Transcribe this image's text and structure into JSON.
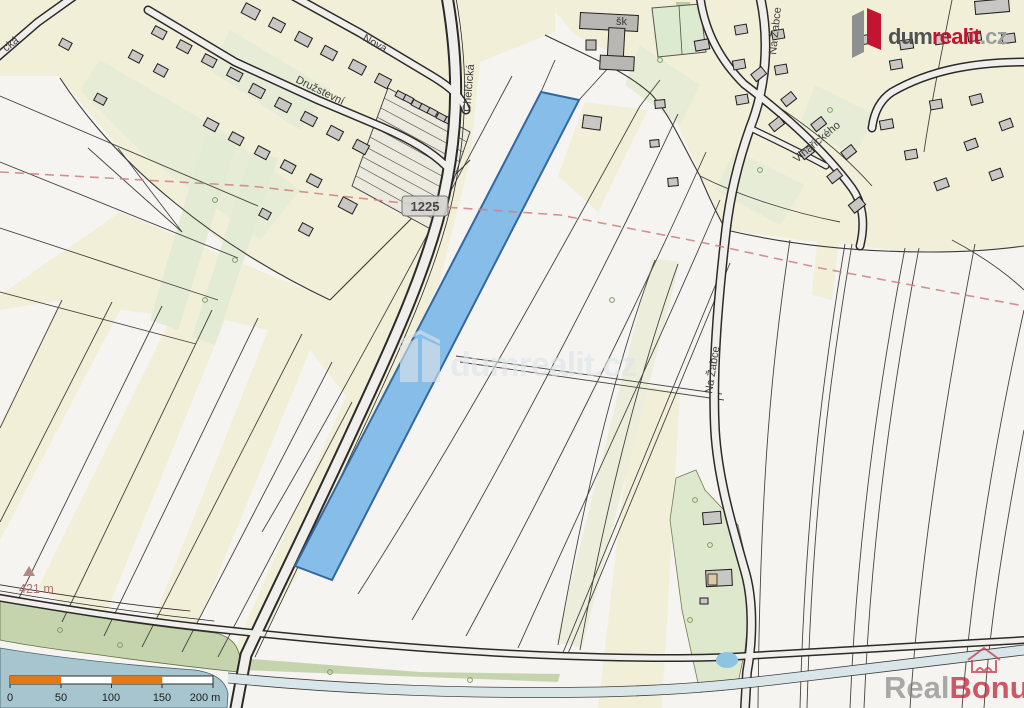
{
  "map_labels": {
    "street_cka_partial": "cká",
    "street_nova": "Nová",
    "street_druzstevni": "Družstevní",
    "street_chelcicka": "Chelčická",
    "street_na_zabce_top": "Na Žabce",
    "street_na_zabce_mid": "Na Žabce",
    "street_vinarickeho": "Vinařického",
    "school_abbreviation": "šk",
    "road_number": "1225",
    "elevation_point": "421 m"
  },
  "scale_bar": {
    "tick_0": "0",
    "tick_50": "50",
    "tick_100": "100",
    "tick_150": "150",
    "tick_200": "200 m"
  },
  "branding": {
    "logo_dum": "dum",
    "logo_realit": "realit",
    "logo_cz": ".cz",
    "watermark_center": "dumrealit.cz",
    "watermark_real": "Real",
    "watermark_bonus": "Bonus",
    "watermark_bonus_cz": ".cz"
  },
  "colors": {
    "highlight_parcel_fill": "#87bde9",
    "highlight_parcel_border": "#33689f",
    "field_cream": "#f2efd8",
    "garden_green": "#e3ebd4",
    "water": "#a7c5ce",
    "scale_orange": "#e07818",
    "logo_red": "#c41431",
    "boundary_red_dash": "#cf7f7f"
  }
}
